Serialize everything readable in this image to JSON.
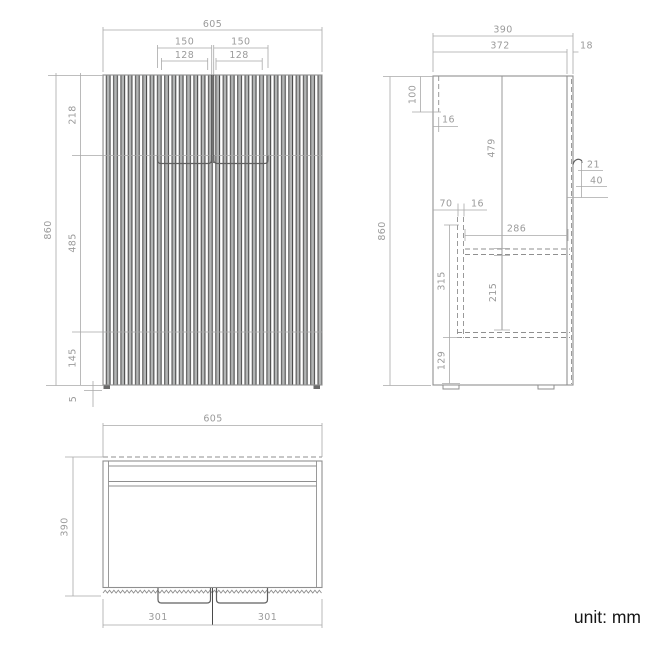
{
  "unit_note": "unit: mm",
  "views": {
    "front": {
      "dims": {
        "overall_width": "605",
        "recess_left": "150",
        "recess_right": "150",
        "handle_left": "128",
        "handle_right": "128",
        "top_section": "218",
        "overall_height": "860",
        "middle_section": "485",
        "bottom_section": "145",
        "foot_height": "5"
      }
    },
    "side": {
      "dims": {
        "overall_depth": "390",
        "carcass_depth": "372",
        "front_thickness": "18",
        "overall_height": "860",
        "top_notch": "100",
        "panel_thickness": "16",
        "door_height": "479",
        "handle_offset": "21",
        "handle_drop": "40",
        "rail_inset": "70",
        "rail_thickness": "16",
        "shelf_depth": "286",
        "shelf_zone": "315",
        "shelf_clearance": "215",
        "plinth_height": "129"
      }
    },
    "top": {
      "dims": {
        "overall_width": "605",
        "overall_depth": "390",
        "door_left": "301",
        "door_right": "301"
      }
    }
  },
  "colors": {
    "background": "#ffffff",
    "line": "#8f8f8f",
    "dim_line": "#a9a9a9",
    "dim_text": "#9b9b9b",
    "dark": "#4a4a4a",
    "slat_light": "#b3b5b5",
    "handle": "#606060",
    "unit_text": "#161616"
  }
}
